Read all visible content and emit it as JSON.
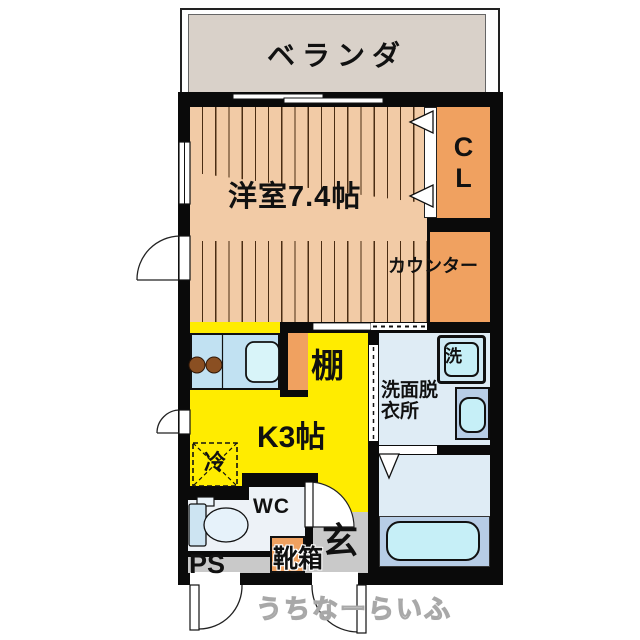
{
  "colors": {
    "wall": "#0a0a0a",
    "wood-floor": "#f2cba6",
    "wood-line": "#4a2c12",
    "accent-orange": "#f0a160",
    "kitchen-yellow": "#ffec00",
    "balcony-beige": "#d9d1c9",
    "water-room": "#dfecf5",
    "fixture-blue": "#cfe9f4",
    "fixture-cyan": "#c6eff7",
    "vanity-blue": "#b7cde6",
    "counter-blue": "#c1e1f2",
    "wc-floor": "#edf2f7",
    "entry-gray": "#c9c9c9",
    "watermark-gray": "#a8a8a8"
  },
  "rooms": {
    "balcony": {
      "label": "ベランダ"
    },
    "western_room": {
      "label": "洋室7.4帖"
    },
    "closet": {
      "line1": "C",
      "line2": "L"
    },
    "counter": {
      "label": "カウンター"
    },
    "kitchen": {
      "label": "K3帖"
    },
    "shelf": {
      "label": "棚"
    },
    "refrigerator": {
      "label": "冷"
    },
    "washroom": {
      "line1": "洗面脱",
      "line2": "衣所"
    },
    "washing_machine": {
      "label": "洗"
    },
    "wc": {
      "label": "WC"
    },
    "entrance": {
      "label": "玄"
    },
    "shoe_box": {
      "label": "靴箱"
    },
    "pipe_space": {
      "label": "PS"
    }
  },
  "watermark": {
    "label": "うちなーらいふ"
  }
}
